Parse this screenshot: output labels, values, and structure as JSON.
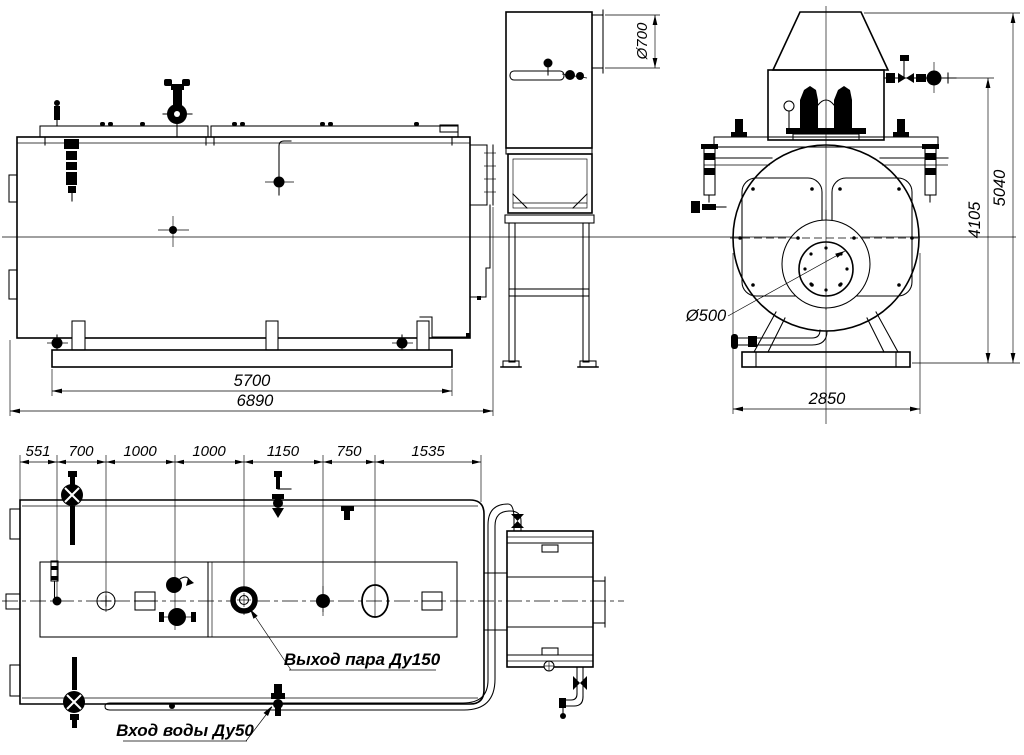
{
  "labels": {
    "side_view": {
      "base_length": "5700",
      "overall_length": "6890"
    },
    "stack_view": {
      "outlet_diameter": "Ø700"
    },
    "front_view": {
      "burner_diameter": "Ø500",
      "height_to_valve": "4105",
      "height_overall": "5040",
      "width_overall": "2850"
    },
    "plan_view": {
      "chain_dimensions": [
        "551",
        "700",
        "1000",
        "1000",
        "1150",
        "750",
        "1535"
      ],
      "steam_outlet_label": "Выход пара Ду150",
      "water_inlet_label": "Вход воды Ду50"
    }
  }
}
